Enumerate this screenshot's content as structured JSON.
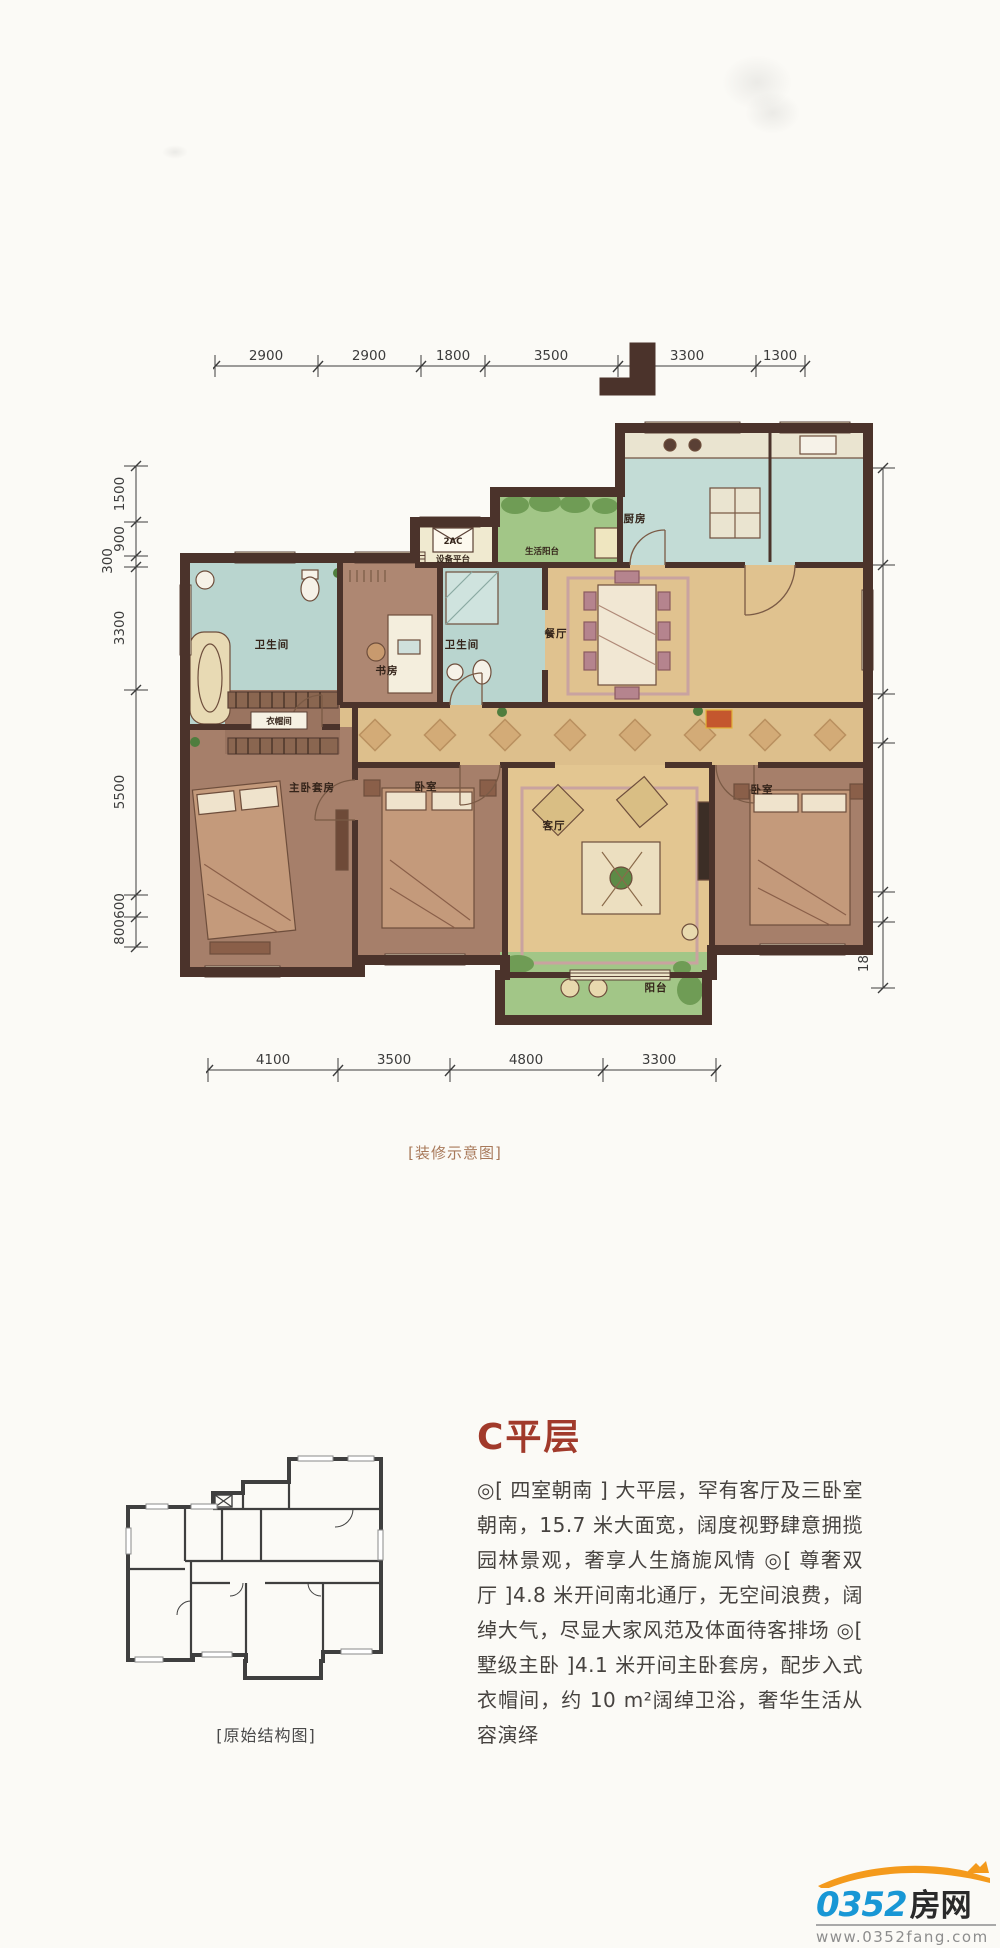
{
  "decorated_plan": {
    "caption": "[装修示意图]",
    "dimensions": {
      "top": [
        "2900",
        "2900",
        "1800",
        "3500",
        "3300",
        "1300"
      ],
      "bottom": [
        "4100",
        "3500",
        "4800",
        "3300"
      ],
      "left": [
        "1500",
        "900",
        "300",
        "3300",
        "5500",
        "600",
        "800"
      ],
      "right": [
        "2600",
        "3400",
        "1300",
        "4000",
        "800",
        "1800"
      ]
    },
    "rooms": {
      "bath_top": "卫生间",
      "study": "书房",
      "bath_mid": "卫生间",
      "equipment_platform": "设备平台",
      "equipment_code": "2AC",
      "service_balcony": "生活阳台",
      "kitchen": "厨房",
      "dining": "餐厅",
      "cloakroom": "衣帽间",
      "master_suite": "主卧套房",
      "bedroom_center": "卧室",
      "living": "客厅",
      "bedroom_right": "卧室",
      "balcony": "阳台"
    },
    "colors": {
      "wall": "#4b332b",
      "wood_floor": "#a87f6a",
      "tile_blue": "#b9d5cf",
      "tan_floor": "#e0c28f",
      "balcony_green": "#a2c687",
      "window_cream": "#ece4c8"
    }
  },
  "original_plan": {
    "caption": "[原始结构图]"
  },
  "description": {
    "title": "C平层",
    "body": "◎[ 四室朝南 ] 大平层，罕有客厅及三卧室朝南，15.7 米大面宽，阔度视野肆意拥揽园林景观，奢享人生旖旎风情 ◎[ 尊奢双厅 ]4.8 米开间南北通厅，无空间浪费，阔绰大气，尽显大家风范及体面待客排场 ◎[ 墅级主卧 ]4.1 米开间主卧套房，配步入式衣帽间，约 10 m²阔绰卫浴，奢华生活从容演绎"
  },
  "watermark": {
    "brand_number": "0352",
    "brand_cn": "房网",
    "url": "www.0352fang.com"
  }
}
